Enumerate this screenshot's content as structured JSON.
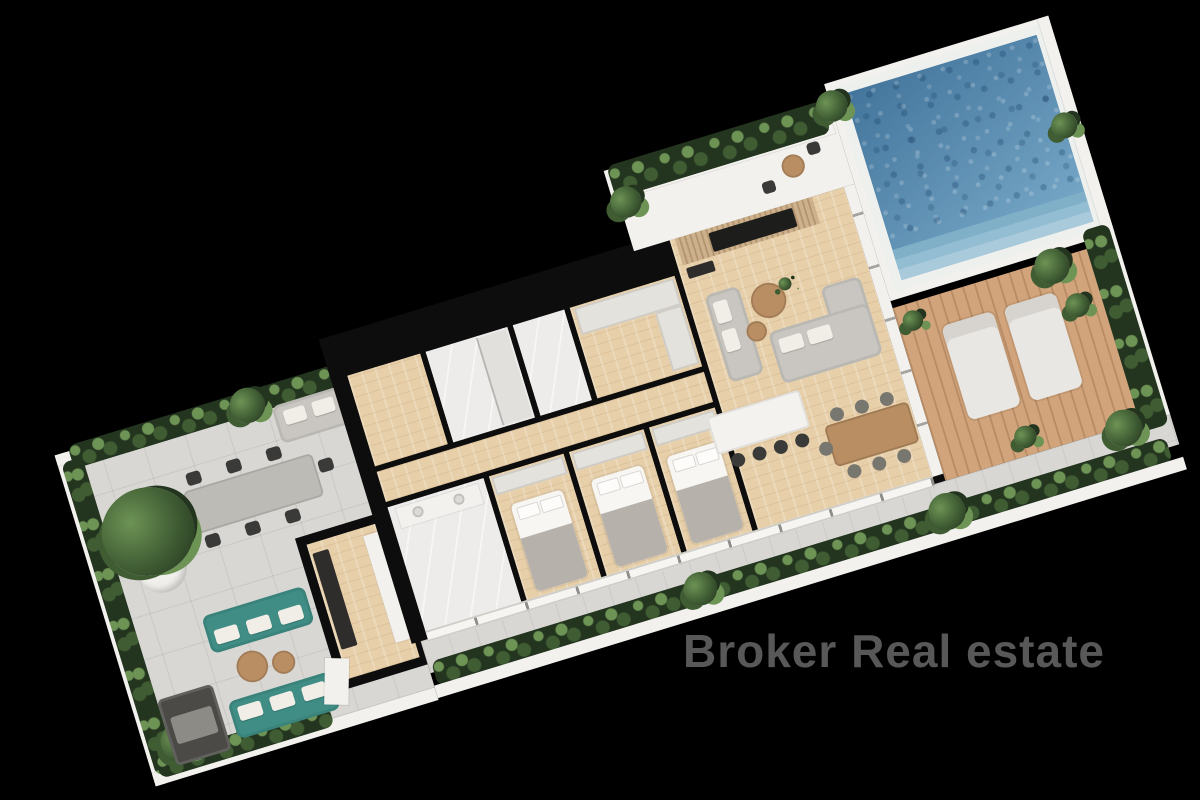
{
  "watermark": {
    "text": "Broker Real estate"
  },
  "palette": {
    "bg": "#000000",
    "tile": "#d8d7d4",
    "wood": "#e7cfa9",
    "marble": "#edecea",
    "wall-dark": "#0d0d0d",
    "wall-white": "#f2f1ee",
    "pool-deep": "#43759c",
    "pool-light": "#7aabca",
    "deck": "#d2a47b",
    "hedge-dark": "#24351f",
    "hedge-mid": "#3f5c33",
    "hedge-light": "#6d9355",
    "sofa-gray": "#c9c6c1",
    "sofa-teal": "#3f8d85",
    "chair-dark": "#3a3a38",
    "wood-furniture": "#b98e63",
    "watermark": "#585858"
  },
  "scene": {
    "type": "3d-floor-plan-render",
    "view": "top-down axonometric render on black background, plan rotated diagonally",
    "areas": [
      "left terrace with outdoor dining and lounge corner",
      "kitchen with dark counter",
      "entry hall and two bathrooms",
      "walk-in closet",
      "corridor",
      "master bathroom with double vanity",
      "three bedrooms with south-facing windows",
      "living and dining room with TV wall",
      "planter terrace with bistro set",
      "swimming pool with entry steps",
      "wooden sun deck with two loungers",
      "south balcony walkway with continuous planter"
    ],
    "furniture": [
      "outdoor dining table with eight black chairs",
      "grey outdoor sofa with cushions",
      "large potted tree",
      "two teal sofas with round wooden coffee tables",
      "dark daybed",
      "two grey living-room sofas and round coffee tables",
      "kitchen island with four bar stools",
      "wooden dining table with seven chairs",
      "three double beds with grey blankets",
      "two sun loungers on the pool deck",
      "bistro table with two chairs"
    ]
  }
}
